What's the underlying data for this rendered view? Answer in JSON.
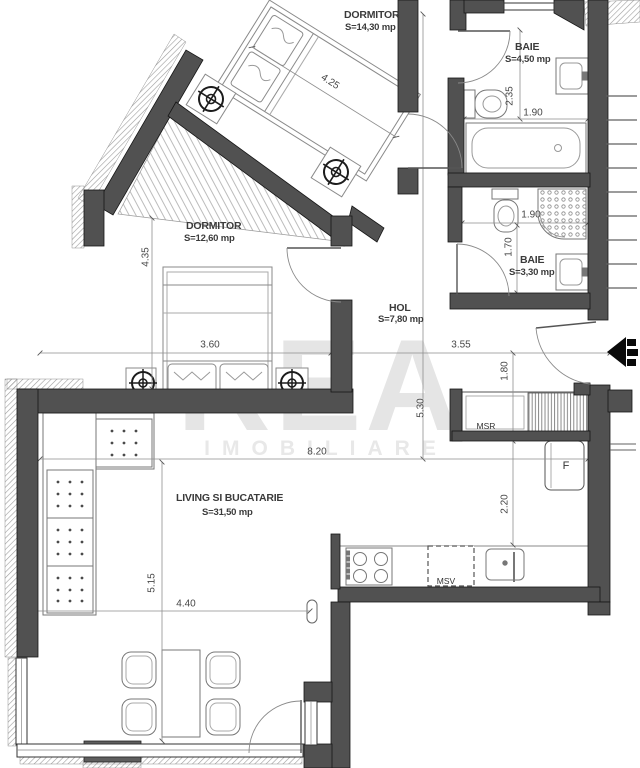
{
  "watermark": {
    "title": "REA",
    "subtitle": "IMOBILIARE"
  },
  "colors": {
    "wall": "#515151",
    "paper": "#ffffff",
    "watermark": "#e5e5e5",
    "dim_line": "#8e8e8e"
  },
  "rooms": {
    "dormitor1": {
      "name": "DORMITOR",
      "area": "S=14,30 mp"
    },
    "baie1": {
      "name": "BAIE",
      "area": "S=4,50 mp"
    },
    "dormitor2": {
      "name": "DORMITOR",
      "area": "S=12,60 mp"
    },
    "baie2": {
      "name": "BAIE",
      "area": "S=3,30 mp"
    },
    "hol": {
      "name": "HOL",
      "area": "S=7,80 mp"
    },
    "living": {
      "name": "LIVING SI BUCATARIE",
      "area": "S=31,50 mp"
    }
  },
  "dimensions": {
    "bed1_length": "4.25",
    "baie1_depth": "2.35",
    "baie1_width": "1.90",
    "baie2_width": "1.90",
    "baie2_depth": "1.70",
    "dormitor2_height": "4.35",
    "dormitor2_width": "3.60",
    "hol_width": "3.55",
    "entry_niche": "1.80",
    "hol_length": "5.30",
    "living_width": "8.20",
    "kitchen_depth": "2.20",
    "living_height": "5.15",
    "living_bottom": "4.40"
  },
  "annotations": {
    "msr": "MSR",
    "msv": "MSV",
    "fridge": "F"
  }
}
